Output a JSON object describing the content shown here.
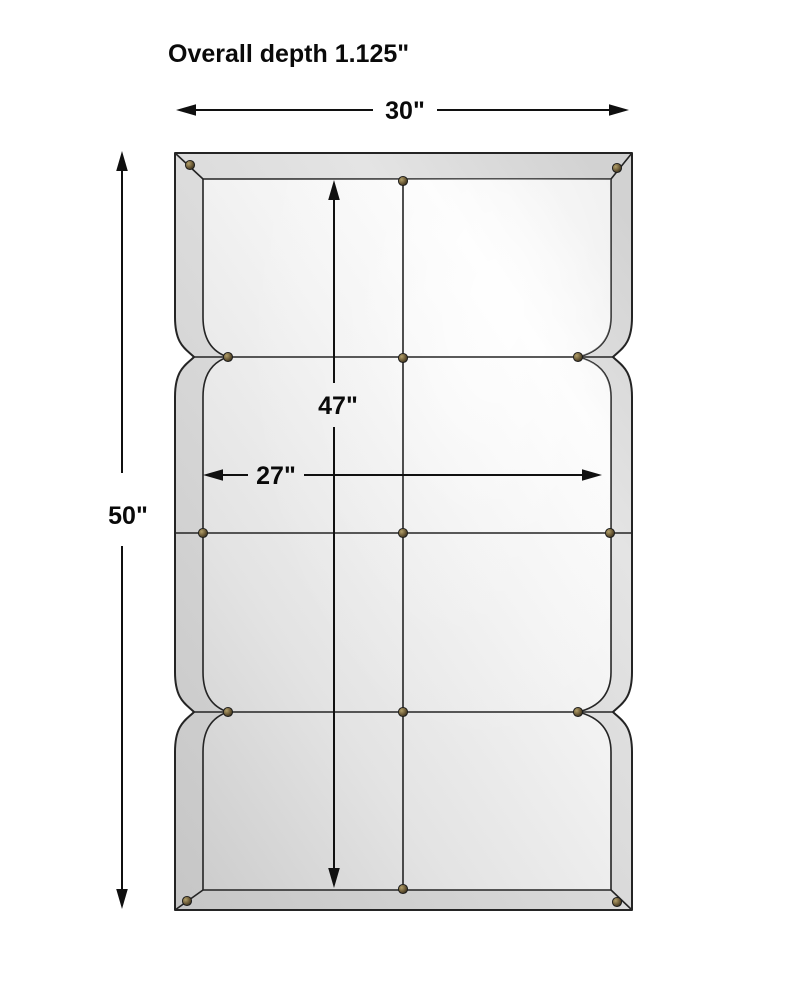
{
  "figure": {
    "kind": "product-dimension-diagram",
    "subject": "paneled beveled wall mirror, front view"
  },
  "annotations": {
    "overall_depth": "Overall depth 1.125\"",
    "width": "30\"",
    "height": "50\"",
    "inner_height": "47\"",
    "inner_width": "27\""
  },
  "colors": {
    "background": "#ffffff",
    "line": "#1c1c1c",
    "text": "#0a0a0a",
    "frame_dark": "#c3c3c3",
    "frame_light": "#dedede",
    "glass_dark": "#cdcdcd",
    "glass_light": "#fbfbfb",
    "screw_brass": "#8a7850"
  }
}
